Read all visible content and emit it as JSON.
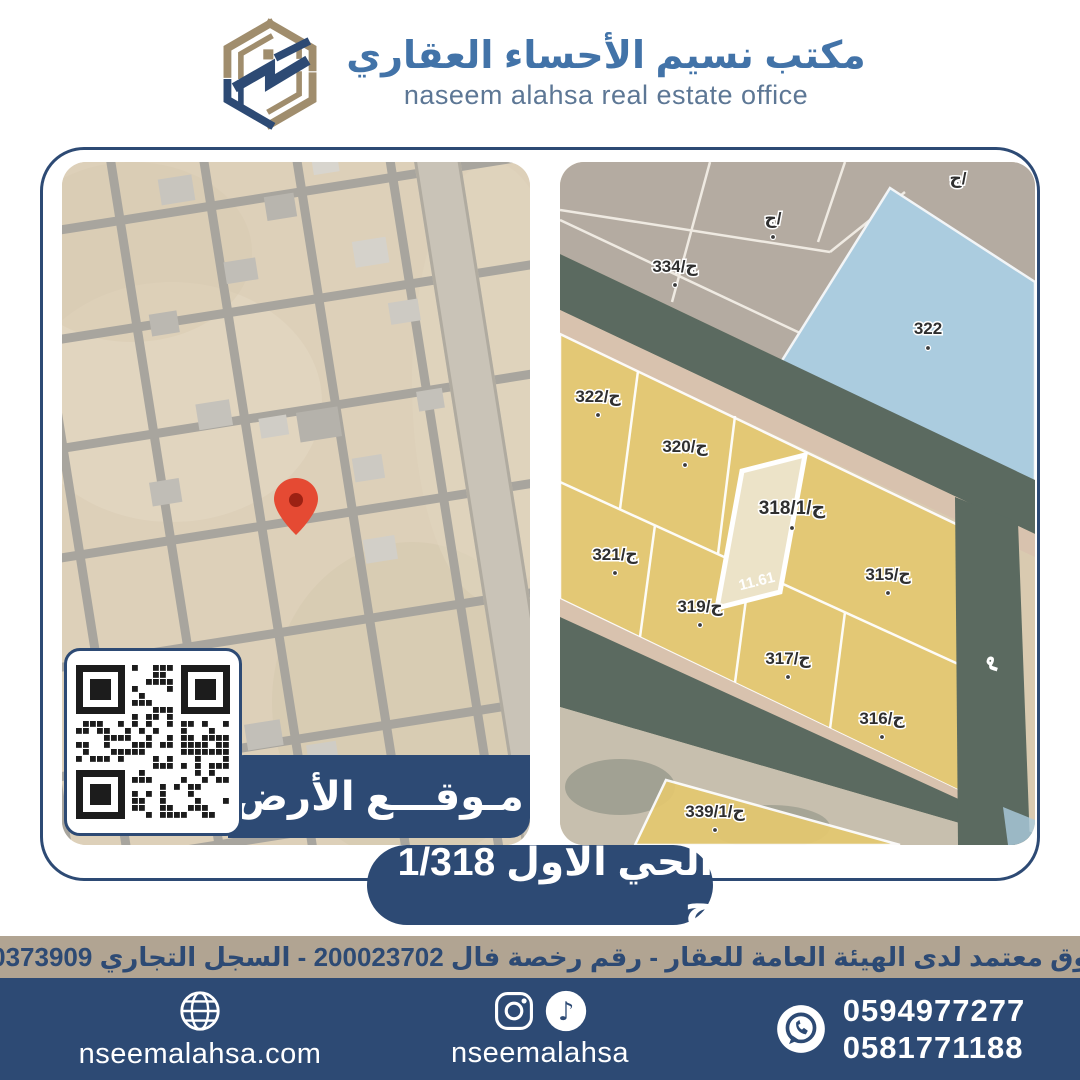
{
  "header": {
    "title_ar": "مكتب نسيم الأحساء العقاري",
    "title_en": "naseem alahsa real estate office"
  },
  "ribbon": {
    "label": "مـوقـــع الأرض"
  },
  "banner": {
    "text": "الحي الاول 1/318 ج"
  },
  "license": {
    "text": "مسوق معتمد لدى الهيئة العامة للعقار - رقم رخصة فال 200023702 - السجل التجاري 2250373909"
  },
  "footer": {
    "website": "nseemalahsa.com",
    "social_handle": "nseemalahsa",
    "phone1": "0594977277",
    "phone2": "0581771188"
  },
  "right_map": {
    "labels": [
      {
        "text": "ج/"
      },
      {
        "text": "ج/"
      },
      {
        "text": "ج/334"
      },
      {
        "text": "322"
      },
      {
        "text": "ج/322"
      },
      {
        "text": "ج/320"
      },
      {
        "text": "ج/318/1"
      },
      {
        "text": "ج/321"
      },
      {
        "text": "ج/315"
      },
      {
        "text": "ج/319"
      },
      {
        "text": "ج/317"
      },
      {
        "text": "ج/316"
      },
      {
        "text": "ج/339/1"
      }
    ],
    "dimension": "11.61",
    "street_letter": "م",
    "highlighted_parcel": "ج/318/1"
  },
  "colors": {
    "navy": "#2d4a74",
    "tan_strip": "#b1a492",
    "logo_gold": "#a08d6d",
    "pin_red": "#e54a33",
    "parcel_yellow": "#e4c870",
    "parcel_blue": "#abccdf",
    "road_dark": "#5b6a60"
  }
}
